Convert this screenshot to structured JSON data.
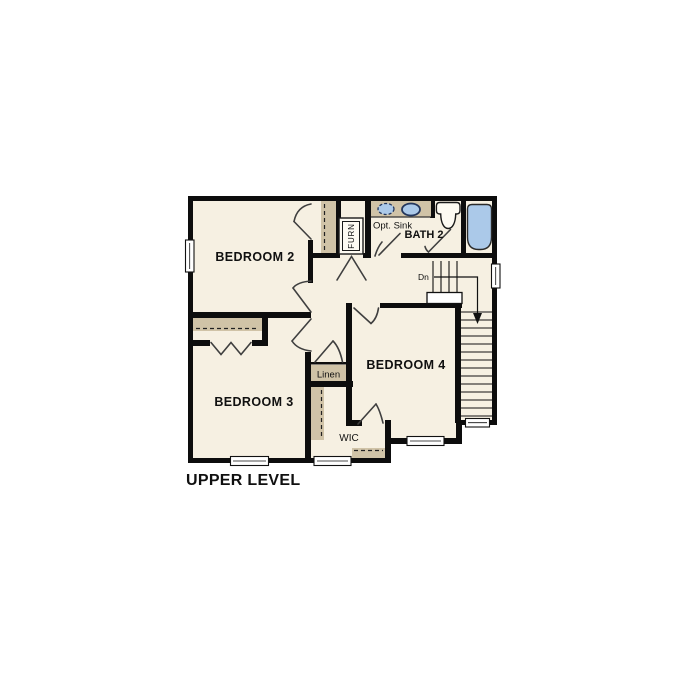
{
  "title": "UPPER LEVEL",
  "rooms": {
    "bedroom2": "BEDROOM 2",
    "bedroom3": "BEDROOM 3",
    "bedroom4": "BEDROOM 4",
    "bath2": "BATH 2"
  },
  "labels": {
    "opt_sink": "Opt. Sink",
    "down": "Dn",
    "linen": "Linen",
    "wic": "WIC",
    "furnace": "FURN"
  },
  "colors": {
    "background": "#ffffff",
    "floor": "#f6f0e2",
    "wall": "#0d0d0d",
    "shelf": "#d0c3a7",
    "fixture_blue": "#abc9e9",
    "door_line": "#3f3f3f"
  }
}
